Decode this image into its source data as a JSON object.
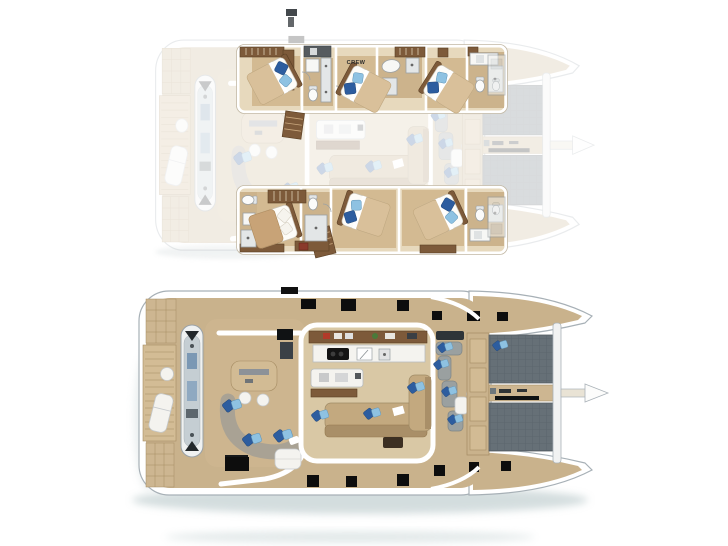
{
  "canvas": {
    "width": 728,
    "height": 546,
    "background": "#ffffff"
  },
  "labels": {
    "crew": "CREW"
  },
  "colors": {
    "page_bg": "#ffffff",
    "hull_stroke": "#a7b0b6",
    "deck_tan": "#c9b28c",
    "salon_floor": "#d9c8a5",
    "cabin_strip": "#e7d9bd",
    "cabin_floor": "#d3ba92",
    "wood_brown": "#7d5a3a",
    "wood_dark": "#5a3f24",
    "counter_white": "#f4f3ef",
    "hatch_black": "#0d0d0d",
    "trampoline_gray": "#667077",
    "sofa_gray": "#a9a294",
    "sofa_tan": "#c3a97f",
    "pillow_blue_dark": "#2d5d9f",
    "pillow_blue_light": "#8ec2e2",
    "water_shadow": "#a9bcbe",
    "label_dark": "#2b2b2b"
  },
  "plans": {
    "cabin_deck": {
      "position": "top",
      "crew_label": "CREW",
      "beds_with_blue_pillows": 5,
      "beds_plain": 1,
      "bathrooms": 6
    },
    "main_deck": {
      "position": "bottom",
      "hatches_port_side": 6,
      "hatches_starboard_side": 7,
      "trampolines": 2
    }
  }
}
